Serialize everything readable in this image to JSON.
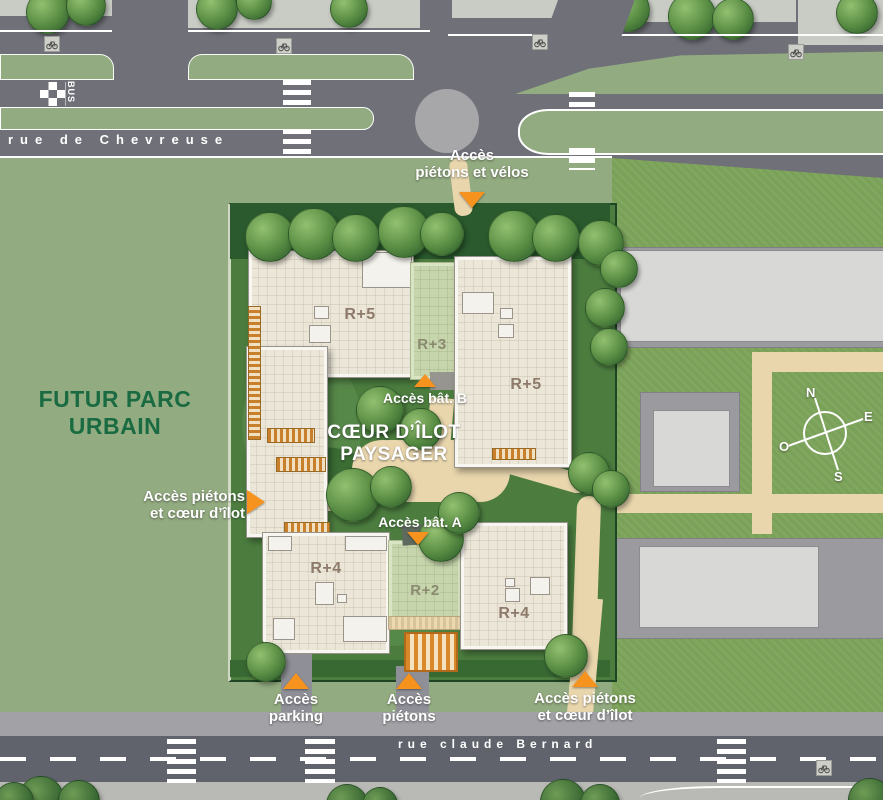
{
  "streets": {
    "chevreuse": "rue de Chevreuse",
    "bernard": "rue claude Bernard",
    "bus": "BUS"
  },
  "park": {
    "line1": "FUTUR PARC",
    "line2": "URBAIN"
  },
  "site": {
    "heart1": "CŒUR D’ÎLOT",
    "heart2": "PAYSAGER",
    "buildings": [
      {
        "id": "west",
        "label": "R+5"
      },
      {
        "id": "center-top",
        "label": "R+3"
      },
      {
        "id": "east",
        "label": "R+5"
      },
      {
        "id": "southwest",
        "label": "R+4"
      },
      {
        "id": "center-bot",
        "label": "R+2"
      },
      {
        "id": "southeast",
        "label": "R+4"
      }
    ]
  },
  "access": {
    "top": {
      "line1": "Accès",
      "line2": "piétons et vélos"
    },
    "left": {
      "line1": "Accès piétons",
      "line2": "et cœur d’îlot"
    },
    "bat_b": {
      "label": "Accès bât. B"
    },
    "bat_a": {
      "label": "Accès bât. A"
    },
    "parking": {
      "line1": "Accès",
      "line2": "parking"
    },
    "pietons": {
      "line1": "Accès",
      "line2": "piétons"
    },
    "bottom_right": {
      "line1": "Accès piétons",
      "line2": "et cœur d’îlot"
    }
  },
  "compass": {
    "n": "N",
    "e": "E",
    "s": "S",
    "o": "O"
  },
  "colors": {
    "accent_orange": "#f6921e",
    "park_green": "#93ab80",
    "site_green": "#4c7d3f",
    "road_gray": "#6f7078",
    "path_beige": "#e9d6ad",
    "roof_cream": "#ebe6d8",
    "green_roof": "#c7d5ac",
    "park_text_green": "#1a6b42"
  }
}
